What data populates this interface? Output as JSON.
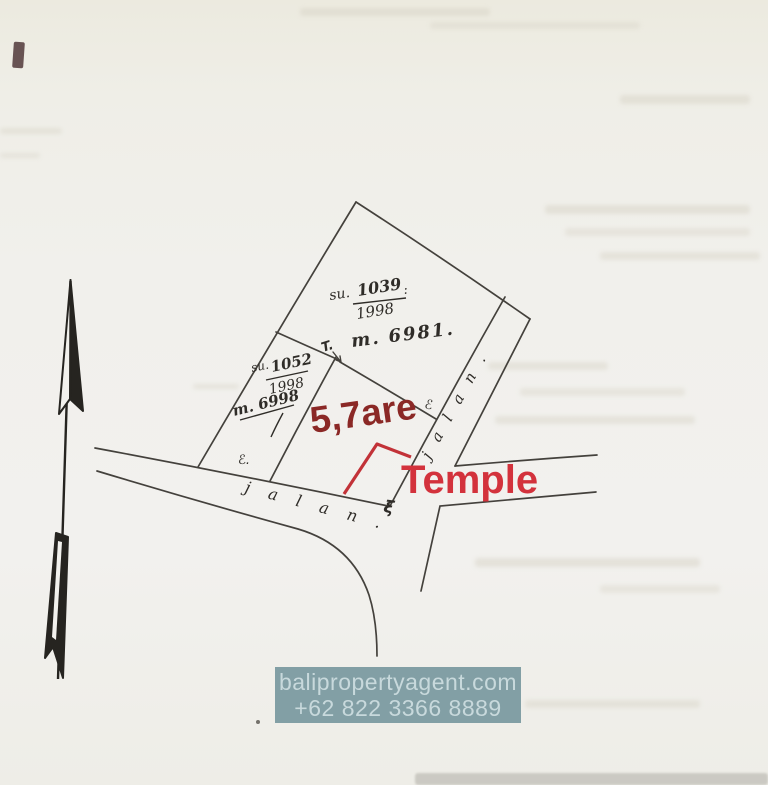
{
  "document": {
    "kind": "scanned hand-drawn land survey sketch"
  },
  "labels": {
    "parcel_top": {
      "su": "su.",
      "num": "1039",
      "colon": ":",
      "den": "1998",
      "meters": "m. 6981."
    },
    "parcel_left": {
      "su": "su.",
      "num": "1052",
      "den": "1998",
      "meters": "m. 6998"
    },
    "area": "5,7are",
    "temple": "Temple",
    "road_bottom": "j a l a n .",
    "road_right": "j a l a n .",
    "marks": {
      "top": "T.",
      "east": "ℰ",
      "west": "ℰ.",
      "temple_point": "ξ"
    }
  },
  "watermark": {
    "line1": "balipropertyagent.com",
    "line2": "+62 822 3366 8889"
  },
  "colors": {
    "paper": "#f1f0ec",
    "ink": "#33302c",
    "red_dark": "#8b2826",
    "red_bright": "#d3323c",
    "watermark_bg": "#7d9ba1",
    "watermark_fg": "#c8d9dc"
  }
}
